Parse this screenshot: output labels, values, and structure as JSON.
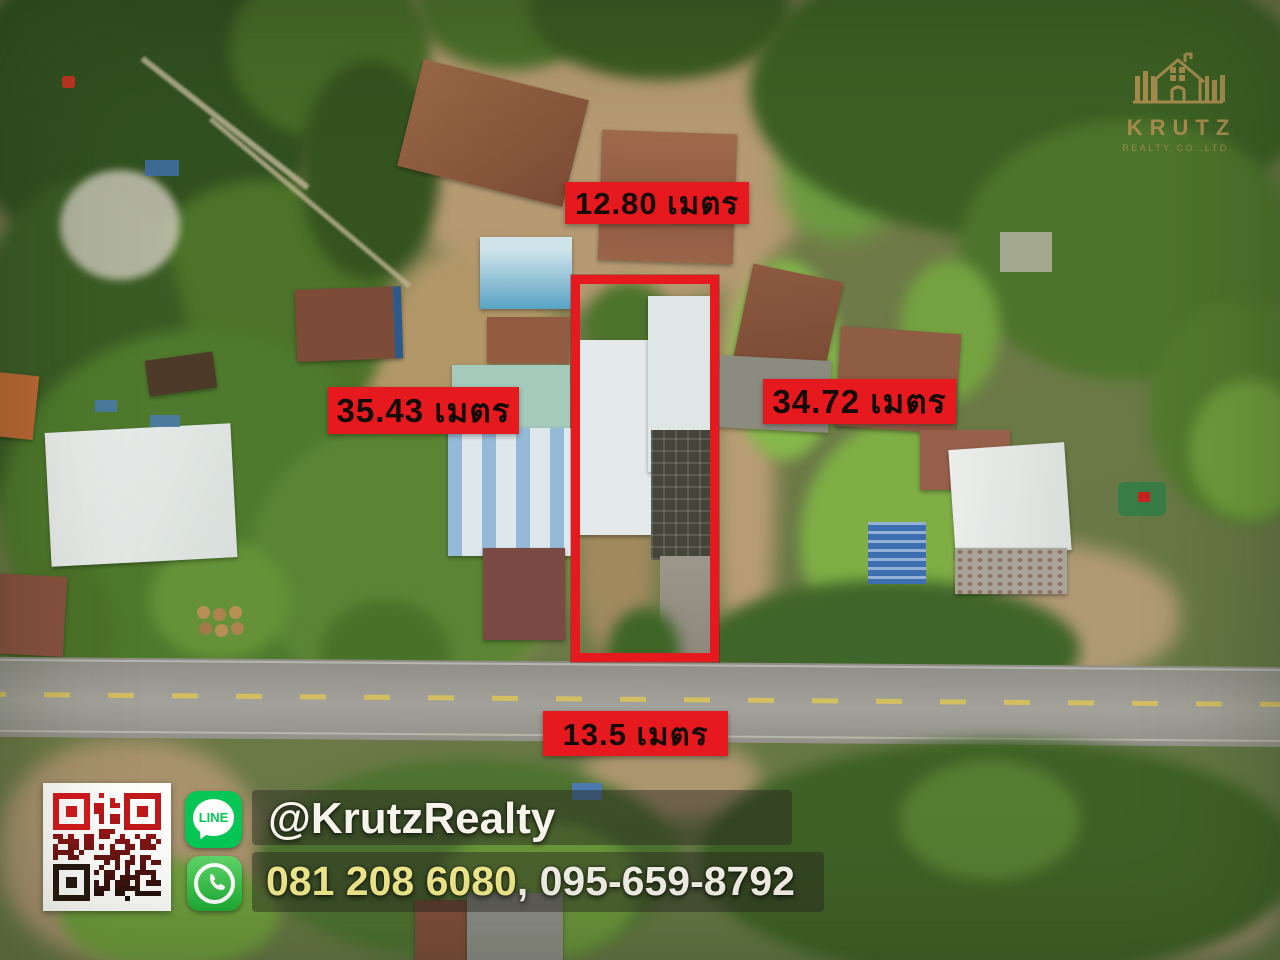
{
  "measurements": {
    "top": "12.80 เมตร",
    "left": "35.43 เมตร",
    "right": "34.72 เมตร",
    "bottom": "13.5 เมตร"
  },
  "logo": {
    "name": "KRUTZ",
    "subtitle": "REALTY CO.,LTD."
  },
  "contact": {
    "line_label": "LINE",
    "line_id": "@KrutzRealty",
    "phone_primary": "081 208 6080",
    "phone_separator": ", ",
    "phone_secondary": "095-659-8792"
  },
  "colors": {
    "label_bg": "#e6191f",
    "label_text": "#140a06",
    "plot_outline": "#e6191f",
    "logo_gold": "#a68d4e",
    "line_green": "#06c755",
    "whatsapp_green": "#2fb843",
    "phone_primary_color": "#f1e98d",
    "phone_secondary_color": "#f4f1e8",
    "qr_top": "#d5191c",
    "qr_bottom": "#1c100c"
  }
}
